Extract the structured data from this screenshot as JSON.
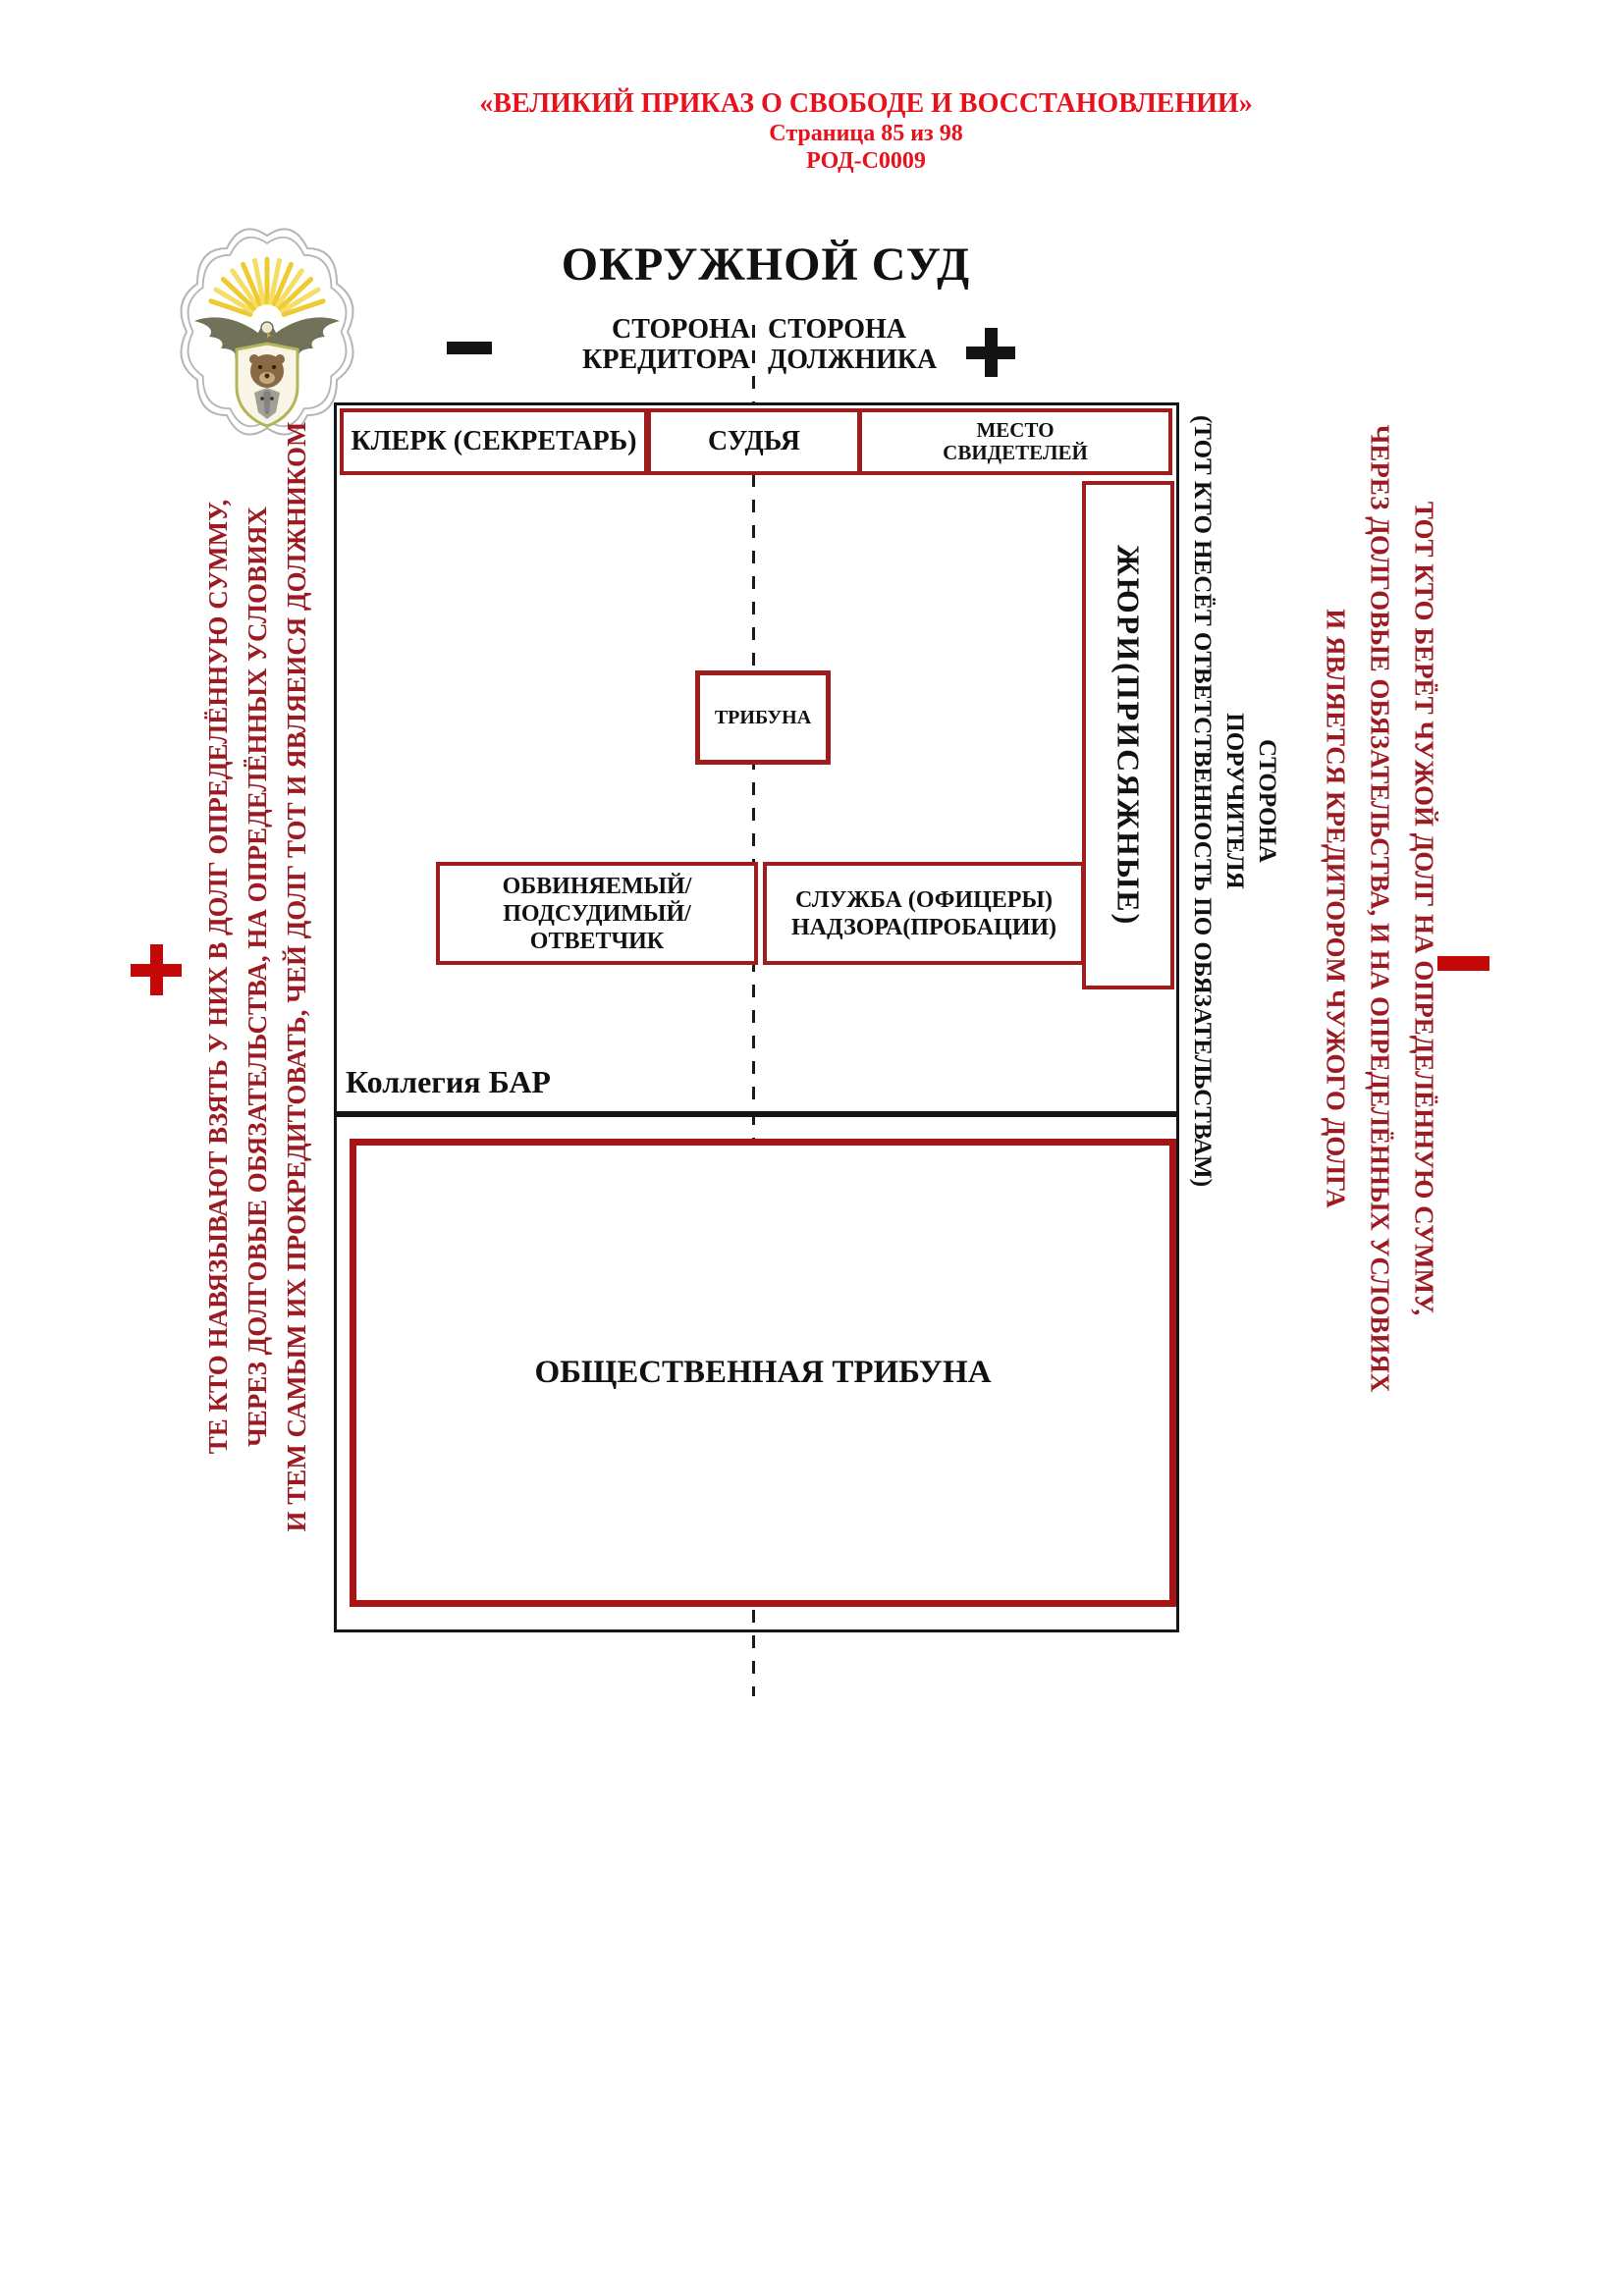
{
  "header": {
    "title_line": "«ВЕЛИКИЙ ПРИКАЗ О СВОБОДЕ И ВОССТАНОВЛЕНИИ»",
    "page_line": "Страница 85 из 98",
    "doc_code": "РОД-С0009"
  },
  "court": {
    "title": "ОКРУЖНОЙ СУД",
    "minus_sign": "−",
    "plus_sign": "+",
    "creditor_side": {
      "line1": "СТОРОНА",
      "line2": "КРЕДИТОРА"
    },
    "debtor_side": {
      "line1": "СТОРОНА",
      "line2": "ДОЛЖНИКА"
    }
  },
  "courtroom": {
    "clerk": "КЛЕРК (СЕКРЕТАРЬ)",
    "judge": "СУДЬЯ",
    "witness": {
      "line1": "МЕСТО",
      "line2": "СВИДЕТЕЛЕЙ"
    },
    "jury": "ЖЮРИ(ПРИСЯЖНЫЕ)",
    "tribune": "ТРИБУНА",
    "defendant": {
      "line1": "ОБВИНЯЕМЫЙ/",
      "line2": "ПОДСУДИМЫЙ/ОТВЕТЧИК"
    },
    "probation": {
      "line1": "СЛУЖБА (ОФИЦЕРЫ)",
      "line2": "НАДЗОРА(ПРОБАЦИИ)"
    },
    "bar": "Коллегия БАР",
    "public_gallery": "ОБЩЕСТВЕННАЯ ТРИБУНА"
  },
  "guarantor_side": {
    "line1": "СТОРОНА",
    "line2": "ПОРУЧИТЕЛЯ",
    "line3": "(ТОТ КТО НЕСЁТ ОТВЕТСТВЕННОСТЬ ПО ОБЯЗАТЕЛЬСТВАМ)"
  },
  "left_margin": {
    "sign": "+",
    "line1": "ТЕ КТО НАВЯЗЫВАЮТ ВЗЯТЬ У НИХ В ДОЛГ ОПРЕДЕЛЁННУЮ СУММУ,",
    "line2": "ЧЕРЕЗ ДОЛГОВЫЕ ОБЯЗАТЕЛЬСТВА, НА ОПРЕДЕЛЁННЫХ УСЛОВИЯХ",
    "line3": "И ТЕМ САМЫМ ИХ ПРОКРЕДИТОВАТЬ, ЧЕЙ ДОЛГ ТОТ И ЯВЛЯЕИСЯ ДОЛЖНИКОМ"
  },
  "right_margin": {
    "sign": "−",
    "line1": "ТОТ КТО БЕРЁТ ЧУЖОЙ ДОЛГ НА ОПРЕДЕЛЁННУЮ СУММУ,",
    "line2": "ЧЕРЕЗ ДОЛГОВЫЕ ОБЯЗАТЕЛЬСТВА, И НА ОПРЕДЕЛЁННЫХ УСЛОВИЯХ",
    "line3": "И ЯВЛЯЕТСЯ КРЕДИТОРОМ ЧУЖОГО ДОЛГА"
  },
  "emblem": {
    "name": "eagle-bear-wolf-emblem"
  },
  "colors": {
    "header_red": "#e8111c",
    "box_border_red": "#9f1d1d",
    "gallery_border_red": "#a81414",
    "margin_red": "#9c1b22",
    "sign_red": "#c40808",
    "ink_black": "#141414"
  }
}
